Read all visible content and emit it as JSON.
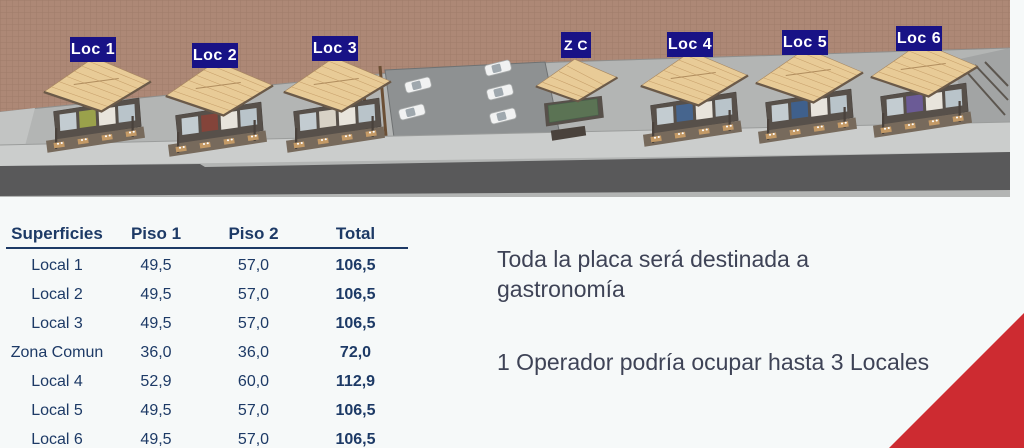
{
  "scene": {
    "labels": {
      "loc1": "Loc 1",
      "loc2": "Loc 2",
      "loc3": "Loc 3",
      "zc": "Z C",
      "loc4": "Loc 4",
      "loc5": "Loc 5",
      "loc6": "Loc 6"
    },
    "icons": [
      "building-icon",
      "car-icon",
      "chalkboard-icon"
    ],
    "colors": {
      "label_navy": "#181286",
      "terrain_tan": "#ad8876",
      "roof_tan": "#e8cb97",
      "road_gray": "#59595a"
    }
  },
  "table": {
    "headers": [
      "Superficies",
      "Piso 1",
      "Piso 2",
      "Total"
    ],
    "rows": [
      {
        "label": "Local 1",
        "piso1": "49,5",
        "piso2": "57,0",
        "total": "106,5"
      },
      {
        "label": "Local 2",
        "piso1": "49,5",
        "piso2": "57,0",
        "total": "106,5"
      },
      {
        "label": "Local 3",
        "piso1": "49,5",
        "piso2": "57,0",
        "total": "106,5"
      },
      {
        "label": "Zona Comun",
        "piso1": "36,0",
        "piso2": "36,0",
        "total": "72,0"
      },
      {
        "label": "Local 4",
        "piso1": "52,9",
        "piso2": "60,0",
        "total": "112,9"
      },
      {
        "label": "Local 5",
        "piso1": "49,5",
        "piso2": "57,0",
        "total": "106,5"
      },
      {
        "label": "Local 6",
        "piso1": "49,5",
        "piso2": "57,0",
        "total": "106,5"
      }
    ]
  },
  "notes": {
    "line1": "Toda la placa será destinada a gastronomía",
    "line2": "1 Operador podría ocupar hasta 3 Locales"
  },
  "colors": {
    "accent_red": "#cd2b31",
    "table_text": "#1d3a66",
    "note_text": "#3e4356",
    "background": "#f6f9f9"
  }
}
